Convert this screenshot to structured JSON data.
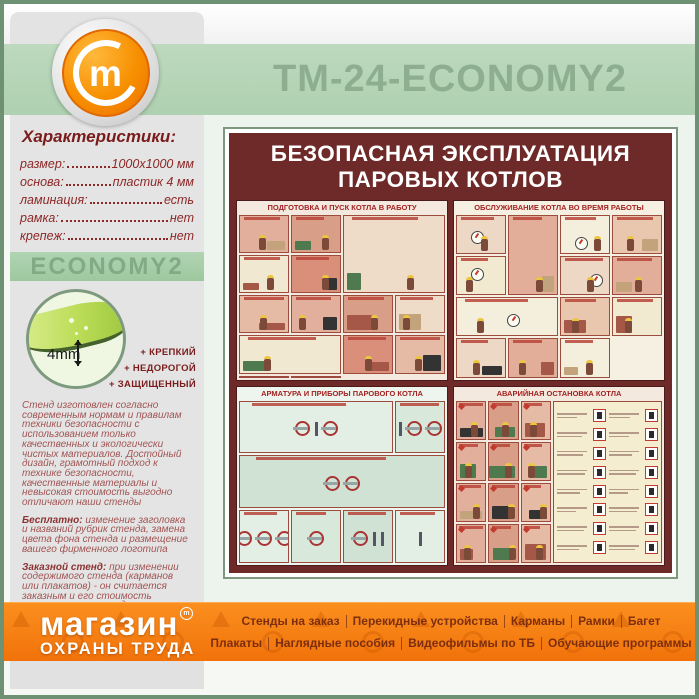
{
  "header": {
    "title": "ТМ-24-ECONOMY2"
  },
  "icons": {
    "header_logo": "m-in-circle",
    "footer_trademark": "m-in-circle-small",
    "footer_watermark": "safety-signs-pattern"
  },
  "sidebar": {
    "section_title": "Характеристики:",
    "specs": [
      {
        "label": "размер:",
        "value": "1000х1000 мм"
      },
      {
        "label": "основа:",
        "value": "пластик 4 мм"
      },
      {
        "label": "ламинация:",
        "value": "есть"
      },
      {
        "label": "рамка:",
        "value": "нет"
      },
      {
        "label": "крепеж:",
        "value": "нет"
      }
    ],
    "model_badge": "ECONOMY2",
    "material": {
      "thickness_label": "4mm",
      "features": [
        "+ КРЕПКИЙ",
        "+ НЕДОРОГОЙ",
        "+ ЗАЩИЩЕННЫЙ"
      ]
    },
    "paragraphs": [
      {
        "segments": [
          {
            "text": "Стенд изготовлен согласно современным нормам и правилам техники безопасности с использованием только качественных и экологически чистых материалов. Достойный дизайн, грамотный подход к технике безопасности, качественные материалы и невысокая стоимость выгодно отличают наши стенды"
          }
        ]
      },
      {
        "segments": [
          {
            "text": "Бесплатно:",
            "bold": true
          },
          {
            "text": " изменение заголовка и названий рубрик стенда, замена цвета фона стенда и размещение вашего фирменного логотипа"
          }
        ]
      },
      {
        "segments": [
          {
            "text": "Заказной стенд:",
            "bold": true
          },
          {
            "text": " при изменении содержимого стенда (карманов или плакатов) - он считается заказным и его стоимость рассчитывается отдельно"
          }
        ]
      },
      {
        "segments": [
          {
            "text": "Изготавливаем "
          },
          {
            "text": "стенды на заказ",
            "bold": true
          },
          {
            "text": " - любого размера, любой комплектации, любого дизайна и оформления"
          }
        ]
      }
    ]
  },
  "poster": {
    "title_line1": "БЕЗОПАСНАЯ ЭКСПЛУАТАЦИЯ",
    "title_line2": "ПАРОВЫХ КОТЛОВ",
    "quadrants": [
      {
        "title": "ПОДГОТОВКА И ПУСК КОТЛА В РАБОТУ",
        "pattern": "workers",
        "bg": "#f3e9df",
        "palette": [
          "#e2af9c",
          "#d99e88",
          "#eedcc8",
          "#f1e8d2",
          "#d98f7a",
          "#e6bba6"
        ]
      },
      {
        "title": "ОБСЛУЖИВАНИЕ КОТЛА ВО ВРЕМЯ РАБОТЫ",
        "pattern": "gauges",
        "bg": "#f6f0e2",
        "palette": [
          "#f1ead0",
          "#ecd8c4",
          "#e2ae9a",
          "#f4efdc",
          "#e9c7ae"
        ]
      },
      {
        "title": "АРМАТУРА И ПРИБОРЫ ПАРОВОГО КОТЛА",
        "pattern": "valves",
        "bg": "#eef5ee",
        "palette": [
          "#d8e8da",
          "#d0e2d3",
          "#e3efe4"
        ]
      },
      {
        "title": "АВАРИЙНАЯ ОСТАНОВКА КОТЛА",
        "pattern": "emergency",
        "bg": "#f3e9df",
        "palette": [
          "#e2af9c",
          "#d99e88",
          "#e6bba6"
        ]
      }
    ]
  },
  "footer": {
    "logo_line1": "магазин",
    "logo_trademark": "m",
    "logo_line2": "ОХРАНЫ ТРУДА",
    "menu_row1": [
      "Стенды на заказ",
      "Перекидные устройства",
      "Карманы",
      "Рамки",
      "Багет"
    ],
    "menu_row2": [
      "Плакаты",
      "Наглядные пособия",
      "Видеофильмы по ТБ",
      "Обучающие программы"
    ]
  },
  "colors": {
    "frame_green": "#6f9173",
    "band_green": "#b7d5b8",
    "title_green": "#8dae90",
    "sidebar_grey": "#e4e4e4",
    "text_dark_red": "#8d2727",
    "poster_maroon": "#6e2a28",
    "footer_orange": "#f57f17",
    "menu_text": "#7d2e0e"
  }
}
